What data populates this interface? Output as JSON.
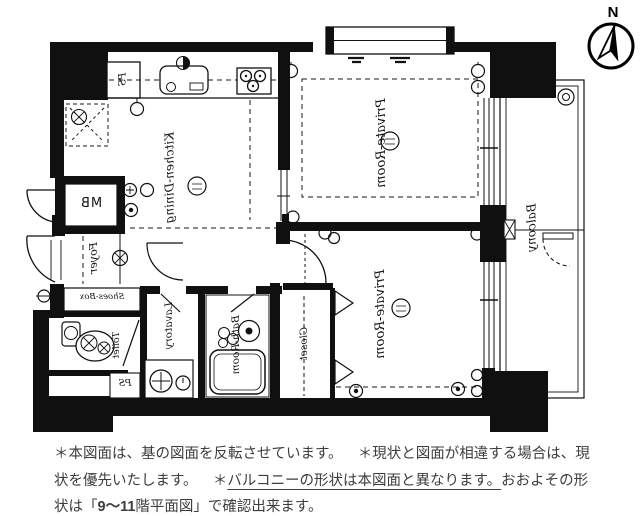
{
  "compass": {
    "label": "N"
  },
  "plan": {
    "room_labels": {
      "kitchen_dining": "Kitchen-Dining",
      "private_room_top": "Private-Room",
      "private_room_bottom": "Private-Room",
      "balcony": "Balcony",
      "foyer": "Foyer",
      "shoes_box": "Shoes-Box",
      "toilet": "Toilet",
      "lavatory": "Lavatory",
      "bath_room": "Bath-Room",
      "closet": "Closet",
      "meter_box": "MB",
      "pipe_space_upper": "PS",
      "pipe_space_lower": "PS"
    }
  },
  "notes": {
    "sentence1": "＊本図面は、基の図面を反転させています。",
    "separator": "　",
    "sentence2": "＊現状と図面が相違する場合は、現状を優先いたします。",
    "sentence3_marker": "＊",
    "sentence3_underlined": "バルコニーの形状は本図面と異なります。",
    "sentence3_tail_a": "おおよその形状は「",
    "floor_range": "9～11",
    "sentence3_tail_b": "階平面図」で確認出来ます。"
  },
  "colors": {
    "ink": "#101010",
    "note_text": "#3d3d3d"
  }
}
